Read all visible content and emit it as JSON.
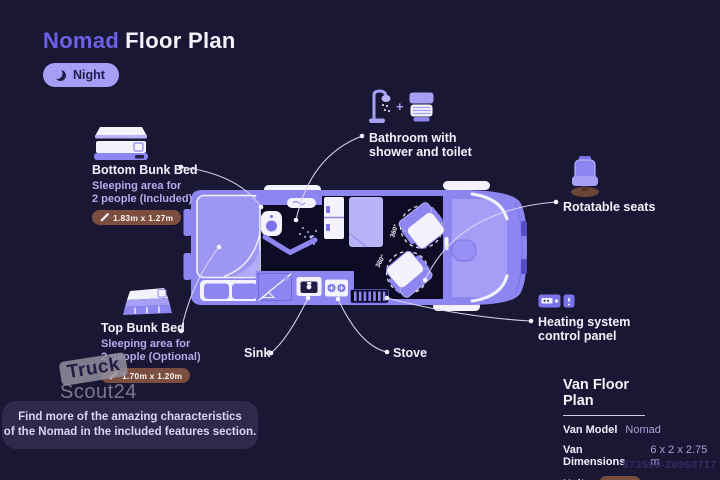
{
  "header": {
    "title_accent": "Nomad",
    "title_rest": "Floor Plan",
    "mode_button": {
      "label": "Night",
      "icon": "moon-icon"
    }
  },
  "callouts": {
    "bottom_bunk": {
      "icon": "bunk-bed-bottom-icon",
      "title": "Bottom Bunk Bed",
      "line1": "Sleeping area for",
      "line2": "2 people (Included)",
      "badge_icon": "ruler-icon",
      "badge": "1.83m x 1.27m"
    },
    "top_bunk": {
      "icon": "bunk-bed-top-icon",
      "title": "Top Bunk Bed",
      "line1": "Sleeping area for",
      "line2": "2 people (Optional)",
      "badge_icon": "ruler-icon",
      "badge": "1.70m x 1.20m"
    },
    "bathroom": {
      "icons": [
        "shower-icon",
        "toilet-icon"
      ],
      "plus": "+",
      "line1": "Bathroom with",
      "line2": "shower and toilet"
    },
    "rotatable_seats": {
      "icon": "swivel-seat-icon",
      "label": "Rotatable seats"
    },
    "heating": {
      "icon": "heater-control-icon",
      "line1": "Heating system",
      "line2": "control panel"
    },
    "sink": {
      "label": "Sink"
    },
    "stove": {
      "label": "Stove"
    }
  },
  "floorplan": {
    "rotation_front": "360°",
    "rotation_rear": "360°"
  },
  "watermark": {
    "top": "Truck",
    "bottom": "Scout24"
  },
  "note": {
    "line1": "Find more of the amazing characteristics",
    "line2": "of the Nomad in the included features section."
  },
  "info_panel": {
    "title": "Van Floor Plan",
    "rows": [
      {
        "label": "Van Model",
        "value": "Nomad"
      },
      {
        "label": "Van Dimensions",
        "value": "6 x 2 x 2.75 m"
      },
      {
        "label": "Units",
        "value": "Meter"
      }
    ]
  },
  "footer": {
    "listing_id": "573580-20960717"
  },
  "colors": {
    "background": "#1a1734",
    "accent_purple": "#6c61e6",
    "night_pill": "#a79ef8",
    "dimension_badge": "#7c4e3f",
    "van_body": "#8d86f0",
    "van_interior": "#0e0b24",
    "white_fixture": "#f4f3fd"
  }
}
